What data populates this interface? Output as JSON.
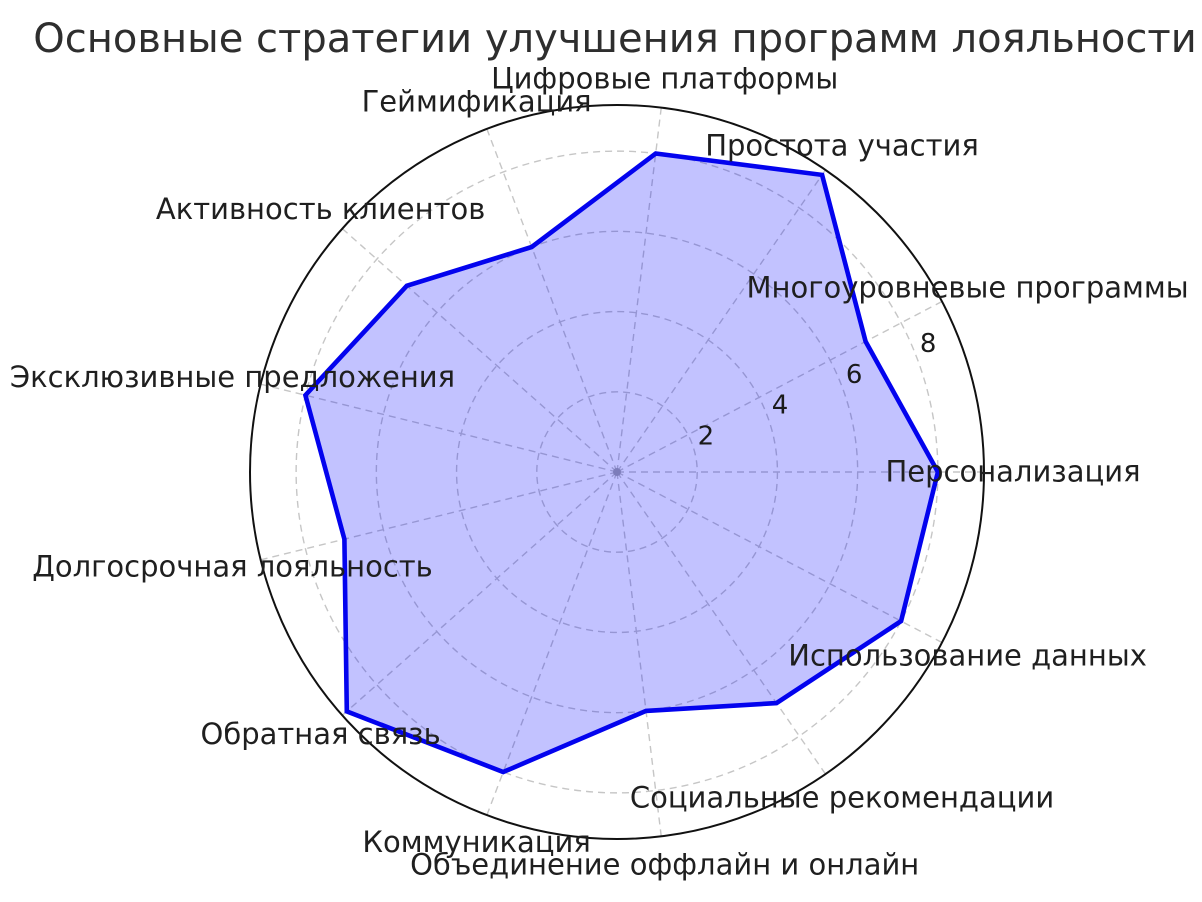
{
  "chart_data": {
    "type": "radar",
    "title": "Основные стратегии улучшения программ лояльности",
    "categories": [
      "Персонализация",
      "Многоуровневые программы",
      "Простота участия",
      "Цифровые платформы",
      "Геймификация",
      "Активность клиентов",
      "Эксклюзивные предложения",
      "Долгосрочная лояльность",
      "Обратная связь",
      "Коммуникация",
      "Объединение оффлайн и онлайн",
      "Социальные рекомендации",
      "Использование данных"
    ],
    "values": [
      8,
      7,
      9,
      8,
      6,
      7,
      8,
      7,
      9,
      8,
      6,
      7,
      8
    ],
    "radial_ticks": [
      2,
      4,
      6,
      8
    ],
    "rlim": [
      0,
      9.15
    ],
    "angle_start_deg": 0,
    "angle_direction": "counterclockwise",
    "tick_label_angle_deg": 22.5,
    "grid": "dashed",
    "legend": "none",
    "colors": {
      "line": "#0303ee",
      "fill": "#0000ff",
      "fill_opacity": 0.24,
      "grid": "#c6c6c6",
      "outer_circle": "#111111",
      "label_text": "#1f1f1f",
      "title_text": "#2e2e2e",
      "center_dot": "#9f9f9f"
    }
  }
}
